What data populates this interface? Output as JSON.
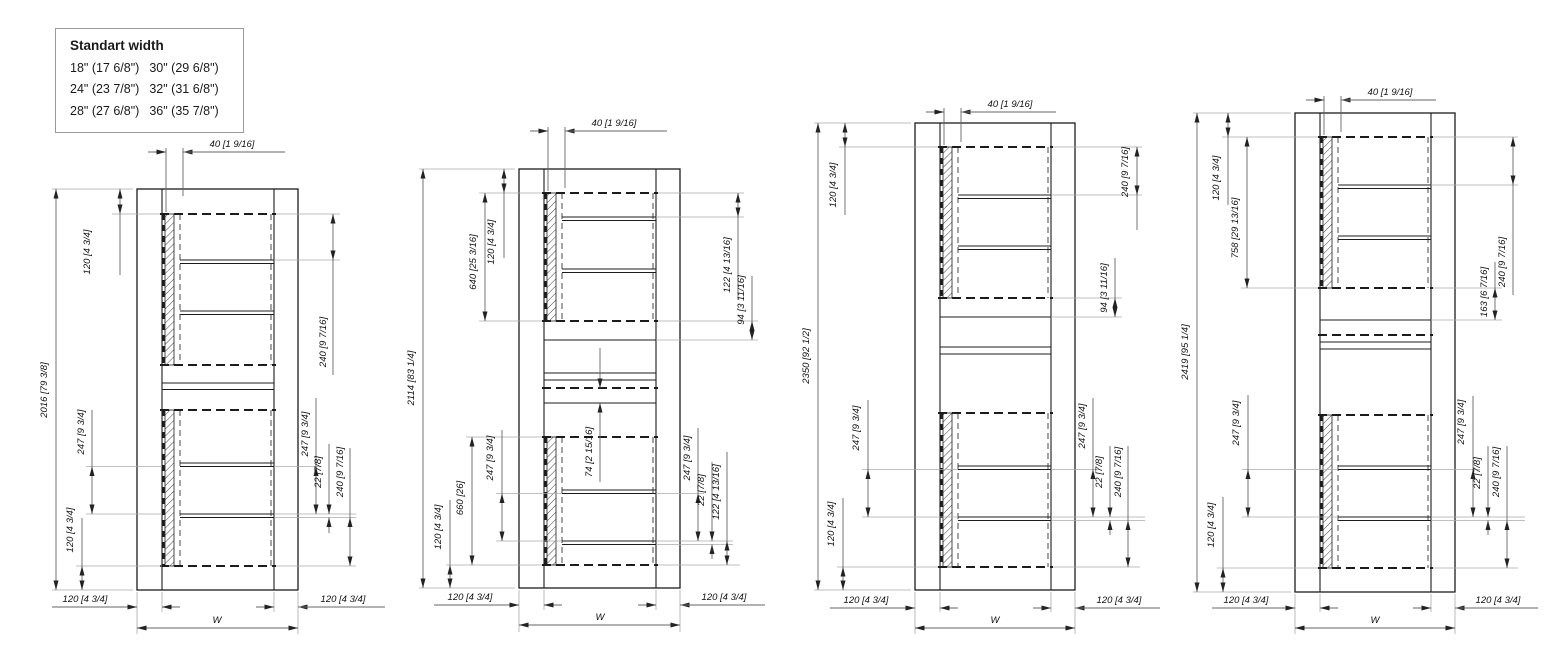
{
  "legend": {
    "title": "Standart width",
    "rows": [
      {
        "left": "18\" (17 6/8\")",
        "right": "30\" (29 6/8\")"
      },
      {
        "left": "24\" (23 7/8\")",
        "right": "32\" (31 6/8\")"
      },
      {
        "left": "28\" (27 6/8\")",
        "right": "36\" (35 7/8\")"
      }
    ]
  },
  "drawings": [
    {
      "overall_height": "2016 [79 3/8]",
      "top_offset": "40 [1 9/16]",
      "left_top_rail": "120 [4 3/4]",
      "left_shelf_pitch": "247 [9 3/4]",
      "left_bottom_rail": "120 [4 3/4]",
      "right_top_spacing": "240 [9 7/16]",
      "right_shelf_pitch": "247 [9 3/4]",
      "shelf_thickness": "22 [7/8]",
      "right_bottom_spacing": "240 [9 7/16]",
      "bottom_left_wall": "120 [4 3/4]",
      "bottom_right_wall": "120 [4 3/4]",
      "width_label": "W"
    },
    {
      "overall_height": "2114 [83 1/4]",
      "top_offset": "40 [1 9/16]",
      "left_top_rail": "120 [4 3/4]",
      "left_upper_opening": "640 [25 3/16]",
      "left_lower_opening": "660 [26]",
      "left_shelf_pitch": "247 [9 3/4]",
      "left_bottom_rail": "120 [4 3/4]",
      "center_gap": "74 [2 15/16]",
      "right_top_spacing": "122 [4 13/16]",
      "right_mid_gap": "94 [3 11/16]",
      "right_shelf_pitch": "247 [9 3/4]",
      "shelf_thickness": "22 [7/8]",
      "right_bottom_spacing": "122 [4 13/16]",
      "bottom_left_wall": "120 [4 3/4]",
      "bottom_right_wall": "120 [4 3/4]",
      "width_label": "W"
    },
    {
      "overall_height": "2350 [92 1/2]",
      "top_offset": "40 [1 9/16]",
      "left_top_rail": "120 [4 3/4]",
      "left_shelf_pitch": "247 [9 3/4]",
      "left_bottom_rail": "120 [4 3/4]",
      "right_top_spacing": "240 [9 7/16]",
      "right_mid_gap": "94 [3 11/16]",
      "right_shelf_pitch": "247 [9 3/4]",
      "shelf_thickness": "22 [7/8]",
      "right_bottom_spacing": "240 [9 7/16]",
      "bottom_left_wall": "120 [4 3/4]",
      "bottom_right_wall": "120 [4 3/4]",
      "width_label": "W"
    },
    {
      "overall_height": "2419 [95 1/4]",
      "top_offset": "40 [1 9/16]",
      "left_top_rail": "120 [4 3/4]",
      "left_upper_opening": "758 [29 13/16]",
      "left_shelf_pitch": "247 [9 3/4]",
      "left_bottom_rail": "120 [4 3/4]",
      "right_top_spacing": "240 [9 7/16]",
      "right_mid_gap": "163 [6 7/16]",
      "right_shelf_pitch": "247 [9 3/4]",
      "shelf_thickness": "22 [7/8]",
      "right_bottom_spacing": "240 [9 7/16]",
      "bottom_left_wall": "120 [4 3/4]",
      "bottom_right_wall": "120 [4 3/4]",
      "width_label": "W"
    }
  ]
}
